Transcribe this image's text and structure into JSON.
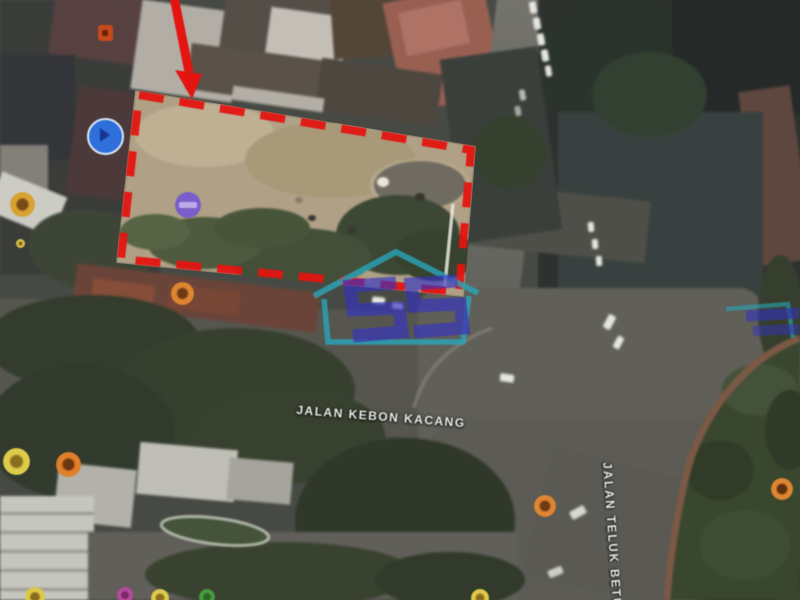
{
  "map": {
    "street_labels": [
      {
        "text": "JALAN KEBON KACANG"
      },
      {
        "text": "JALAN TELUK BETUNG"
      }
    ],
    "watermark": {
      "text": "SS",
      "frame_color": "#2AA6BB",
      "letter_color": "#3433C6"
    },
    "annotation": {
      "boundary_color": "#E41410",
      "boundary_style": "dashed",
      "arrow_color": "#E41410"
    },
    "markers": [
      {
        "name": "red-square-marker",
        "type": "square",
        "x": 105,
        "y": 33,
        "d": 15,
        "h": 16,
        "fill": "#C64A1C",
        "inner": "#6E2008"
      },
      {
        "name": "blue-direction-marker",
        "type": "blue",
        "x": 103,
        "y": 134,
        "d": 33,
        "fill": "#2E6FDB",
        "ring": "#DCE8F6",
        "inner": "#16368F"
      },
      {
        "name": "amber-poi-marker",
        "type": "dot",
        "x": 22,
        "y": 204,
        "d": 25,
        "fill": "#D7A232",
        "inner": "#7A4A14"
      },
      {
        "name": "purple-transit-marker",
        "type": "purple",
        "x": 188,
        "y": 205,
        "d": 26,
        "fill": "#7A5ECB",
        "inner": "#BCABE8"
      },
      {
        "name": "yellow-speck-marker",
        "type": "dot",
        "x": 20,
        "y": 243,
        "d": 9,
        "fill": "#D8C84A",
        "inner": "#8A6E1E"
      },
      {
        "name": "orange-poi-marker-1",
        "type": "dot",
        "x": 182,
        "y": 293,
        "d": 23,
        "fill": "#DD8530",
        "inner": "#6E3A14"
      },
      {
        "name": "yellow-poi-marker",
        "type": "dot",
        "x": 16,
        "y": 461,
        "d": 27,
        "fill": "#DECB4A",
        "inner": "#8A6E1E"
      },
      {
        "name": "orange-poi-marker-2",
        "type": "dot",
        "x": 68,
        "y": 464,
        "d": 25,
        "fill": "#DF7F2A",
        "inner": "#6E3610"
      },
      {
        "name": "orange-poi-marker-3",
        "type": "dot",
        "x": 545,
        "y": 506,
        "d": 22,
        "fill": "#DD8530",
        "inner": "#6E3A14"
      },
      {
        "name": "orange-poi-marker-4",
        "type": "dot",
        "x": 782,
        "y": 489,
        "d": 22,
        "fill": "#DD8530",
        "inner": "#5E2E0E"
      },
      {
        "name": "yellow-edge-marker-1",
        "type": "dot",
        "x": 35,
        "y": 597,
        "d": 20,
        "fill": "#DEC84A",
        "inner": "#8A6E1E"
      },
      {
        "name": "magenta-edge-marker",
        "type": "dot",
        "x": 125,
        "y": 595,
        "d": 16,
        "fill": "#B84A9E",
        "inner": "#7A2A6A"
      },
      {
        "name": "yellow-edge-marker-2",
        "type": "dot",
        "x": 160,
        "y": 598,
        "d": 18,
        "fill": "#DEC84A",
        "inner": "#8A6E1E"
      },
      {
        "name": "green-edge-marker",
        "type": "dot",
        "x": 207,
        "y": 597,
        "d": 16,
        "fill": "#4A9A40",
        "inner": "#2A6A24"
      },
      {
        "name": "yellow-edge-marker-3",
        "type": "dot",
        "x": 480,
        "y": 598,
        "d": 18,
        "fill": "#DEC84A",
        "inner": "#8A6E1E"
      }
    ]
  }
}
